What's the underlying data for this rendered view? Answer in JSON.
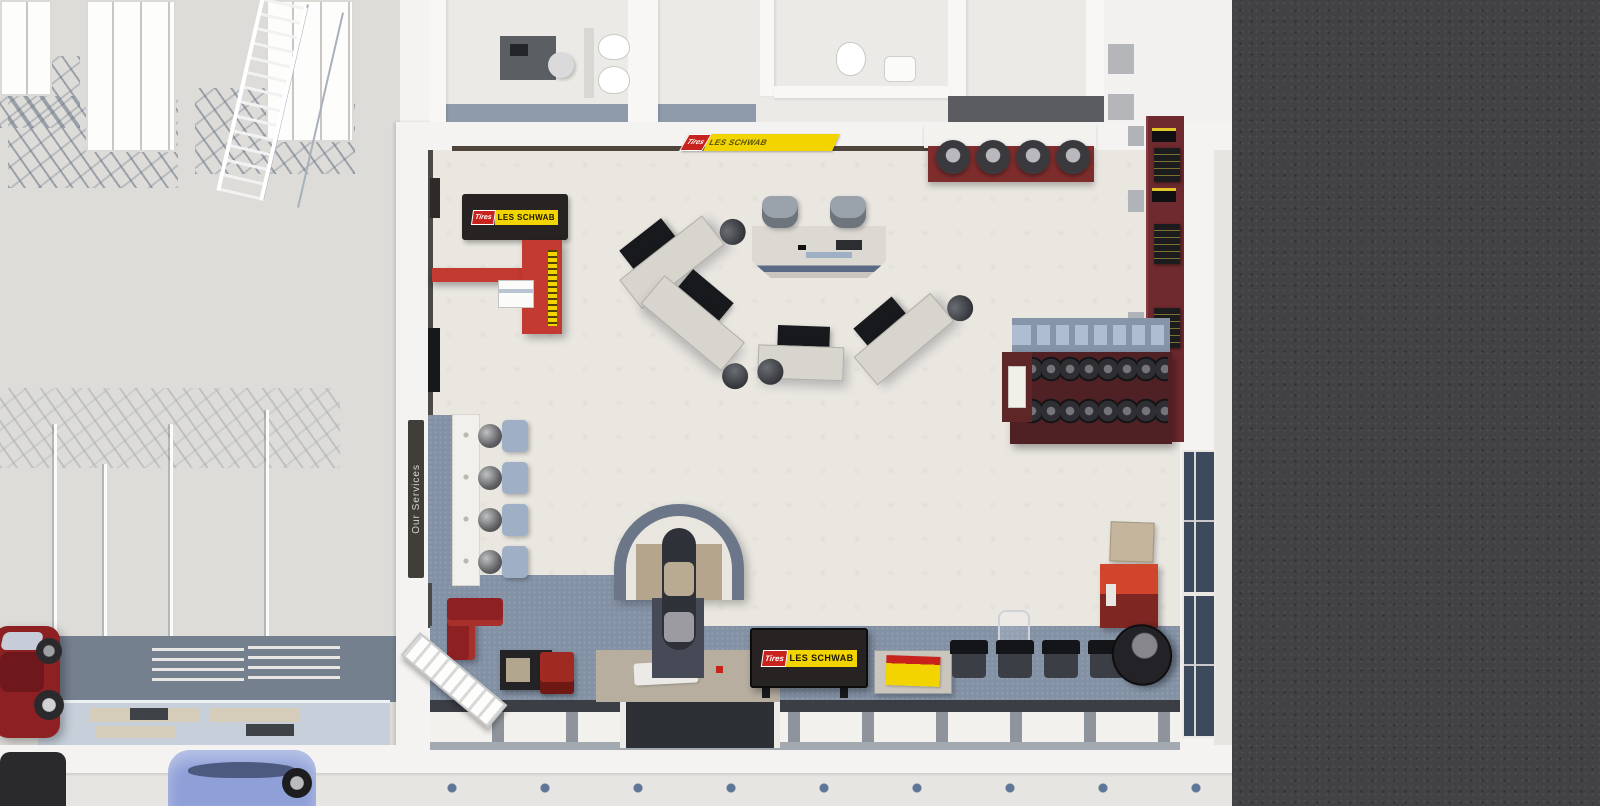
{
  "palette": {
    "asphalt": "#424244",
    "sidewalk": "#e7e5e1",
    "outer_wall": "#f4f3f1",
    "room_floor": "#eceae6",
    "showroom_floor": "#eae7e1",
    "warehouse_floor": "#dedcd8",
    "carpet": "#8391a5",
    "window_glass": "#3d4a5e",
    "brand_red": "#c8221d",
    "brand_yellow": "#f2d500",
    "sign_black": "#262322",
    "display_maroon": "#6e2a2e",
    "counter_red": "#c23a30",
    "accent_orange": "#d0452c",
    "car_red": "#8d2023",
    "car_blue": "#8fa0d8"
  },
  "signs": {
    "top_wall": {
      "tires": "Tires",
      "brand": "LES SCHWAB"
    },
    "entry_mat": {
      "tires": "Tires",
      "brand": "LES SCHWAB"
    },
    "storefront": {
      "tires": "Tires",
      "brand": "LES SCHWAB"
    },
    "services": {
      "label": "Our Services"
    }
  }
}
